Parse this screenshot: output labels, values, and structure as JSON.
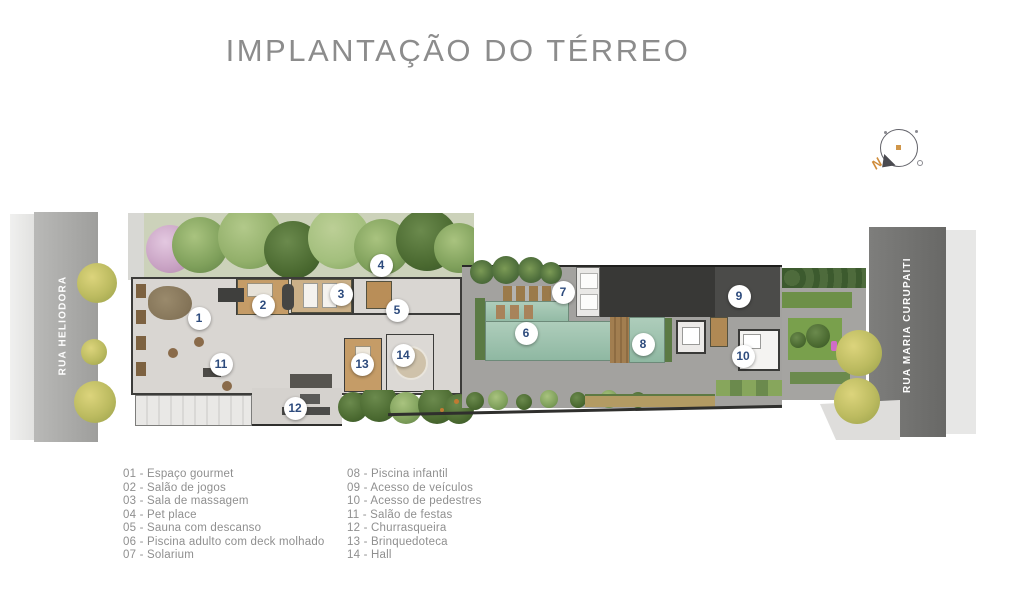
{
  "title": "IMPLANTAÇÃO DO TÉRREO",
  "compass": {
    "north_label": "N"
  },
  "roads": {
    "left": "RUA HELIODORA",
    "right": "RUA MARIA CURUPAITI"
  },
  "markers": [
    {
      "num": "1",
      "label": "Espaço gourmet",
      "x": 199,
      "y": 318
    },
    {
      "num": "2",
      "label": "Salão de jogos",
      "x": 263,
      "y": 305
    },
    {
      "num": "3",
      "label": "Sala de massagem",
      "x": 341,
      "y": 294
    },
    {
      "num": "4",
      "label": "Pet place",
      "x": 381,
      "y": 265
    },
    {
      "num": "5",
      "label": "Sauna com descanso",
      "x": 397,
      "y": 310
    },
    {
      "num": "6",
      "label": "Piscina adulto com deck molhado",
      "x": 526,
      "y": 333
    },
    {
      "num": "7",
      "label": "Solarium",
      "x": 563,
      "y": 292
    },
    {
      "num": "8",
      "label": "Piscina infantil",
      "x": 643,
      "y": 344
    },
    {
      "num": "9",
      "label": "Acesso de veículos",
      "x": 739,
      "y": 296
    },
    {
      "num": "10",
      "label": "Acesso de pedestres",
      "x": 743,
      "y": 356
    },
    {
      "num": "11",
      "label": "Salão de festas",
      "x": 221,
      "y": 364
    },
    {
      "num": "12",
      "label": "Churrasqueira",
      "x": 295,
      "y": 408
    },
    {
      "num": "13",
      "label": "Brinquedoteca",
      "x": 362,
      "y": 364
    },
    {
      "num": "14",
      "label": "Hall",
      "x": 403,
      "y": 355
    }
  ],
  "legend_columns": [
    {
      "items": [
        {
          "num": "01",
          "label": "Espaço gourmet"
        },
        {
          "num": "02",
          "label": "Salão de jogos"
        },
        {
          "num": "03",
          "label": "Sala de massagem"
        },
        {
          "num": "04",
          "label": "Pet place"
        },
        {
          "num": "05",
          "label": "Sauna com descanso"
        },
        {
          "num": "06",
          "label": "Piscina adulto com deck molhado"
        },
        {
          "num": "07",
          "label": "Solarium"
        }
      ]
    },
    {
      "items": [
        {
          "num": "08",
          "label": "Piscina infantil"
        },
        {
          "num": "09",
          "label": "Acesso de veículos"
        },
        {
          "num": "10",
          "label": "Acesso de pedestres"
        },
        {
          "num": "11",
          "label": "Salão de festas"
        },
        {
          "num": "12",
          "label": "Churrasqueira"
        },
        {
          "num": "13",
          "label": "Brinquedoteca"
        },
        {
          "num": "14",
          "label": "Hall"
        }
      ]
    }
  ],
  "colors": {
    "title_text": "#8c8c8c",
    "legend_text": "#8f8f8f",
    "marker_number": "#2d4b7d",
    "road_left": "#a6a6a4",
    "road_right": "#717170",
    "sidewalk": "#e6e6e4",
    "building_floor": "#d9d6d2",
    "wood_floor": "#c59c67",
    "pool_water": "#9cc0ac",
    "garage_roof": "#3d3d3b",
    "greenery": "#7fa05b",
    "compass_north": "#cf8c3a"
  }
}
